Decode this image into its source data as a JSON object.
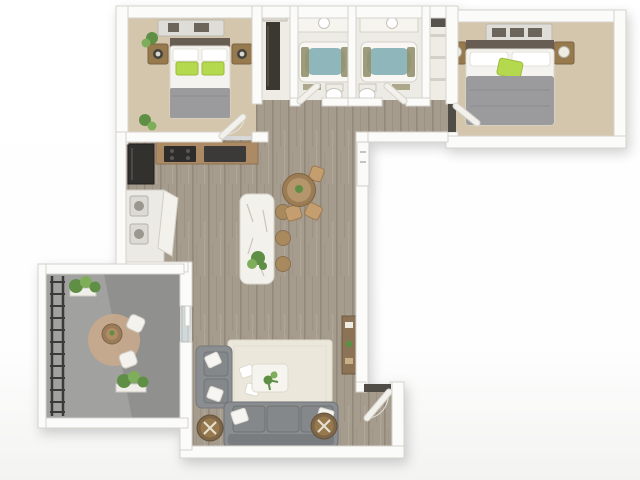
{
  "scene": {
    "title": "3D Floor Plan — 2 Bedroom 2 Bath Apartment with Balcony",
    "type": "floorplan-3d-render",
    "background": "#ffffff",
    "orientation": "top-down dollhouse view, L-shaped unit"
  },
  "palette": {
    "bg": "#ffffff",
    "wall": "#fbfbfa",
    "wall_edge": "#d6d3cd",
    "carpet": "#d4c6ac",
    "tile": "#edebe5",
    "closet_floor": "#efece6",
    "wood": "#a69c8e",
    "wood_grain": "#93897b",
    "balcony_floor": "#a1a1a0",
    "railing": "#3a3a3a",
    "tub_water": "#8fb6ba",
    "bath_olive": "#94916e",
    "counter": "#ab8a64",
    "appliance": "#33312e",
    "island": "#f3f1ec",
    "island_vein": "#c9c5ba",
    "stool": "#a9895e",
    "table_wood": "#9c7c55",
    "chair_wood": "#c59e6f",
    "sofa": "#8b8e90",
    "sofa_cushion": "#85888a",
    "sofa_back": "#7a7d80",
    "pillow": "#f6f5f1",
    "bed_white": "#f4f3ef",
    "bed_gray": "#9b9b9d",
    "headboard": "#675d52",
    "accent_green": "#b5d94e",
    "plant": "#5f8f45",
    "plant_light": "#7fae5b",
    "pot": "#4a4337",
    "drum": "#7e6648",
    "drum_top": "#97794e",
    "rug": "#ece7db",
    "rug_outdoor": "#c8a98c",
    "console_wood": "#8d7355",
    "closet_dark": "#3b3731",
    "door": "#f3f1ec",
    "threshold": "#504c46",
    "glass": "#cfd9da",
    "laundry": "#dcdad5",
    "dresser": "#dfddd7",
    "dresser_dark": "#6b655c"
  },
  "rooms": {
    "bedroom1": {
      "name": "Bedroom 1",
      "floor": "carpet",
      "furniture": [
        "dresser",
        "queen bed with white duvet, gray throw, green pillows",
        "two wood nightstands with lamps",
        "plants"
      ]
    },
    "closet1": {
      "name": "Bedroom 1 Closet",
      "furniture": [
        "hanging clothes",
        "shelf"
      ]
    },
    "bathroom1": {
      "name": "Bathroom 1",
      "floor": "tile",
      "furniture": [
        "vanity with sink",
        "bathtub",
        "toilet",
        "bath mat"
      ]
    },
    "bathroom2": {
      "name": "Bathroom 2",
      "floor": "tile",
      "furniture": [
        "vanity with sink",
        "bathtub",
        "toilet",
        "bath mat"
      ]
    },
    "linen_closet": {
      "name": "Linen Closet",
      "furniture": [
        "shelves"
      ]
    },
    "hallway": {
      "name": "Hallway",
      "floor": "wood"
    },
    "bedroom2": {
      "name": "Bedroom 2",
      "floor": "carpet",
      "furniture": [
        "dresser with dark drawer fronts",
        "queen bed with gray duvet, white pillows, green accent pillow",
        "two nightstands with white lamps"
      ]
    },
    "kitchen": {
      "name": "Kitchen",
      "floor": "wood",
      "furniture": [
        "refrigerator",
        "counter with range and appliances",
        "stacked washer dryer closet",
        "marble island with plant",
        "three bar stools",
        "round dining table with chairs",
        "utility panel"
      ]
    },
    "living": {
      "name": "Living Room",
      "floor": "wood",
      "furniture": [
        "cream area rug",
        "coffee table with plant",
        "gray three-seat sofa with white pillows",
        "gray accent chair with white pillows",
        "two round wood drum tables",
        "media console",
        "entry door"
      ]
    },
    "balcony": {
      "name": "Balcony",
      "floor": "concrete",
      "furniture": [
        "metal railing",
        "round outdoor rug",
        "bistro table",
        "two white chairs",
        "two planters with greenery"
      ]
    }
  },
  "unit_summary": {
    "bedrooms": 2,
    "bathrooms": 2,
    "features": [
      "balcony",
      "in-unit laundry",
      "kitchen island",
      "open living-dining"
    ]
  }
}
